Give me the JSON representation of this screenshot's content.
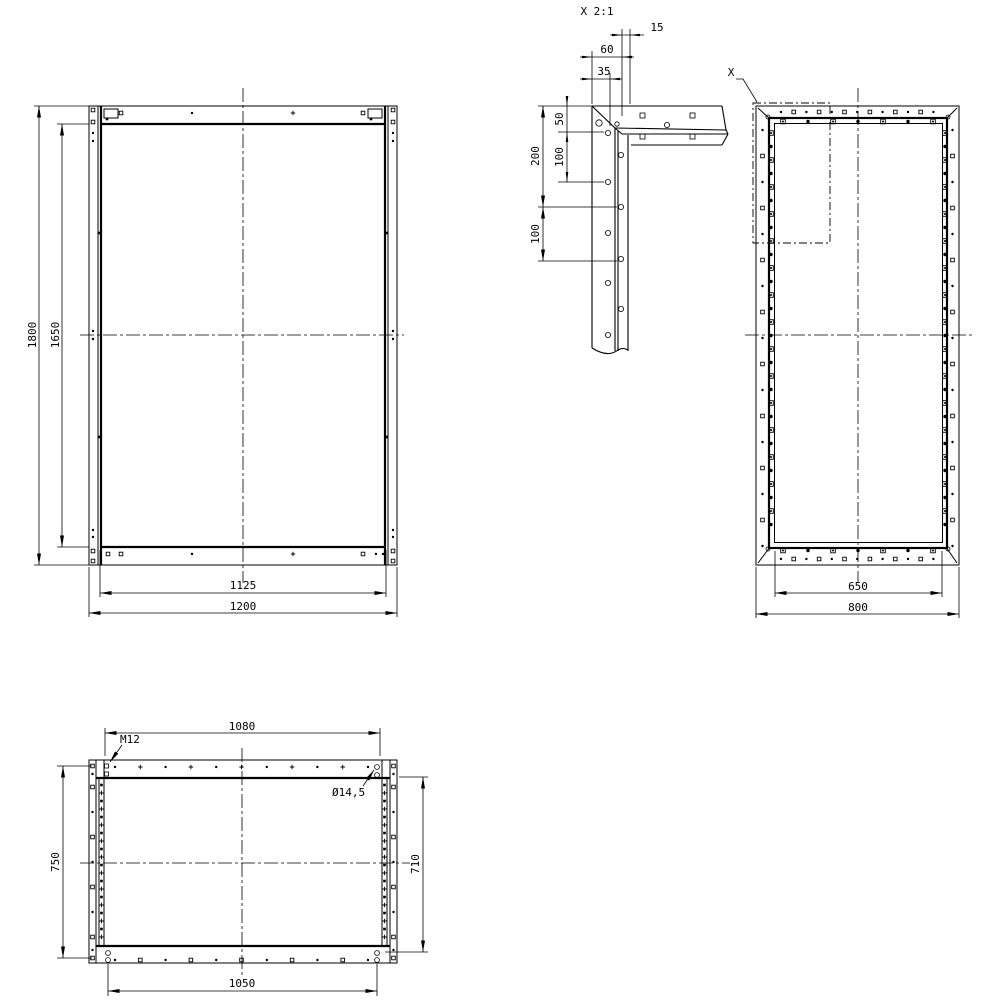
{
  "front_view": {
    "height_outer": "1800",
    "height_inner": "1650",
    "width_inner": "1125",
    "width_outer": "1200"
  },
  "side_view": {
    "detail_marker": "X",
    "width_inner": "650",
    "width_outer": "800"
  },
  "top_view": {
    "width_top_holes": "1080",
    "width_bottom_holes": "1050",
    "height_outer": "750",
    "height_inner": "710",
    "thread_callout": "M12",
    "hole_diameter_callout": "Ø14,5"
  },
  "detail_view": {
    "title": "X 2:1",
    "offset_15": "15",
    "offset_60": "60",
    "offset_35": "35",
    "spacing_50": "50",
    "spacing_100_upper": "100",
    "span_200": "200",
    "spacing_100_lower": "100"
  }
}
